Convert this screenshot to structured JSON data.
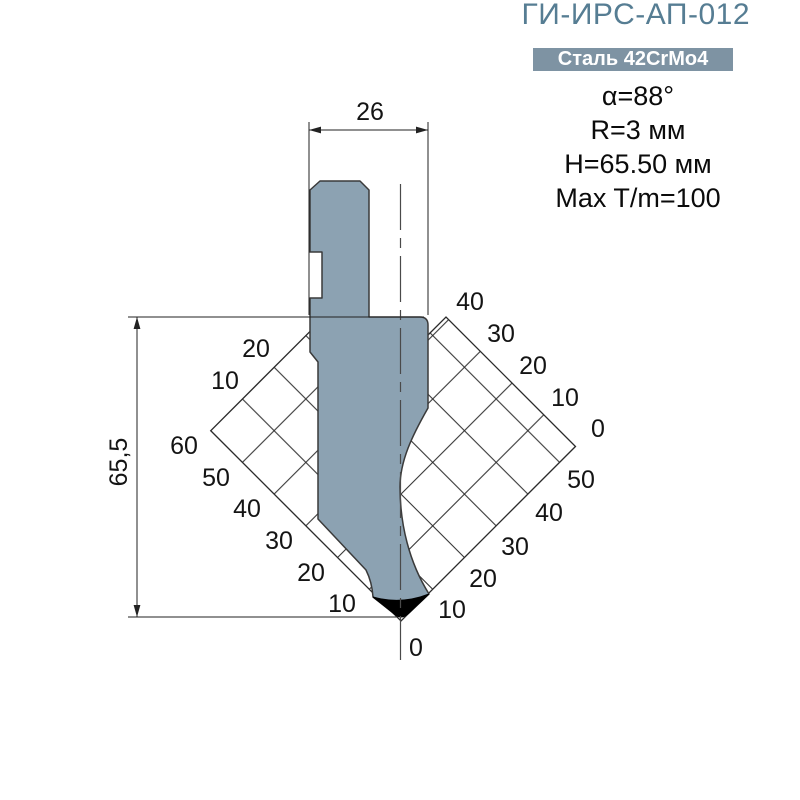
{
  "header": {
    "title": "ГИ-ИРС-АП-012",
    "badge": "Сталь 42CrMo4",
    "specs": [
      "α=88°",
      "R=3 мм",
      "H=65.50 мм",
      "Max T/m=100"
    ]
  },
  "drawing": {
    "dim_width": "26",
    "dim_height": "65,5",
    "grid_labels": {
      "origin": "0",
      "lower_left": [
        "10",
        "20",
        "30",
        "40",
        "50",
        "60"
      ],
      "upper_left": [
        "10",
        "20"
      ],
      "lower_right": [
        "10",
        "20",
        "30",
        "40",
        "50"
      ],
      "upper_right": [
        "0",
        "10",
        "20",
        "30",
        "40"
      ]
    }
  },
  "colors": {
    "punch": "#8ca2b2",
    "tip": "#000000",
    "title": "#567d93",
    "badge_bg": "#7e93a3",
    "grid_line": "#2b2b2b"
  }
}
